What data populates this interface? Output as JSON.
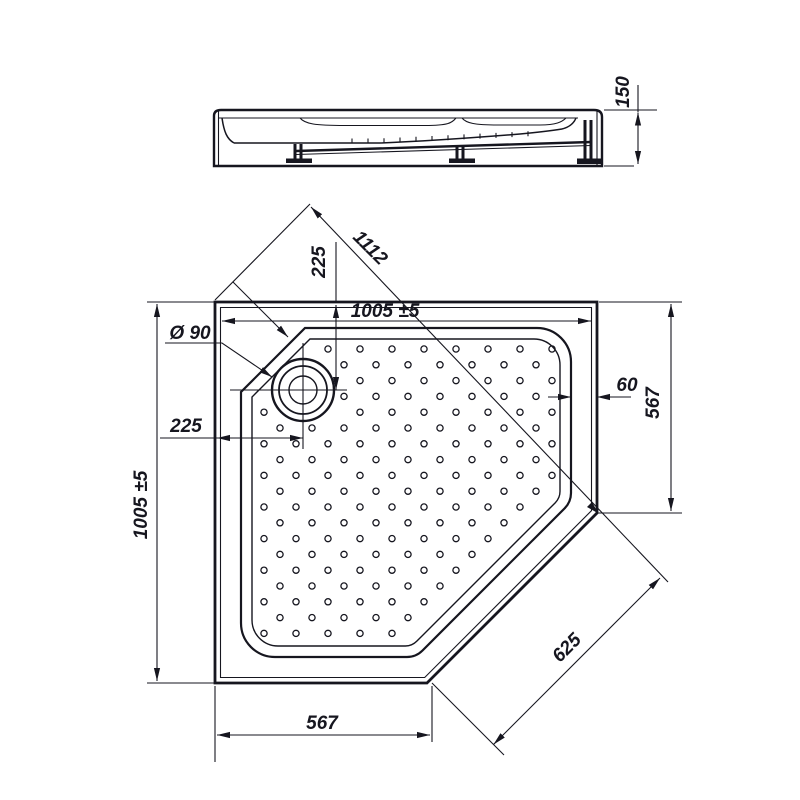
{
  "drawing_title": "corner-shower-tray-technical-drawing",
  "colors": {
    "line": "#16161f",
    "background": "#ffffff"
  },
  "side": {
    "height": "150"
  },
  "plan": {
    "width_top": "1005 ±5",
    "height_left": "1005 ±5",
    "diagonal": "1112",
    "offset_vertical": "225",
    "offset_horizontal": "225",
    "drain_diameter": "Ø 90",
    "rim_width": "60",
    "right_side": "567",
    "bottom_side": "567",
    "chamfer": "625"
  }
}
